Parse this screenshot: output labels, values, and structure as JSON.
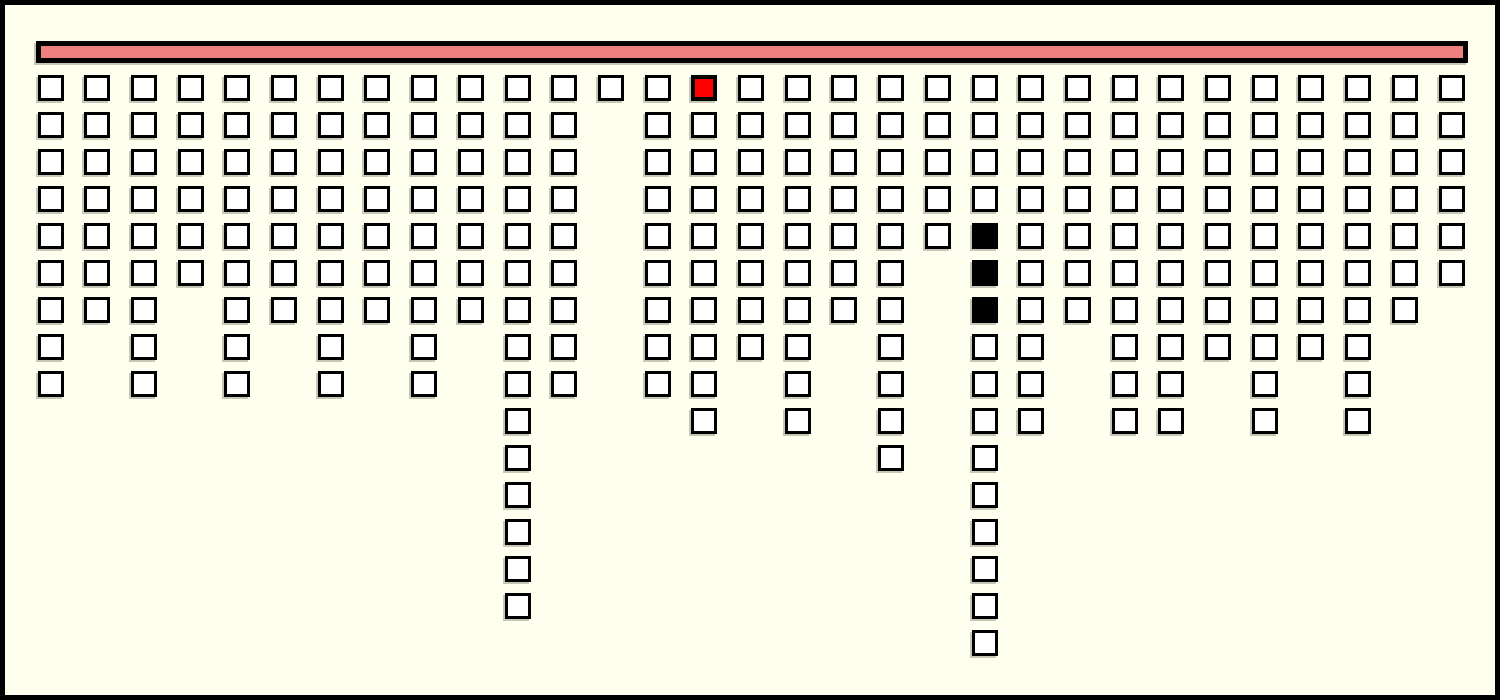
{
  "frame": {
    "description": "Plain framed board, no visible text anywhere",
    "width_px": 1500,
    "height_px": 700
  },
  "top_bar": {
    "role": "horizontal header bar the unit columns hang from"
  },
  "chart_data": {
    "type": "unit-column",
    "title": "",
    "xlabel": "",
    "ylabel": "",
    "orientation": "columns of unit squares hang downward from a horizontal bar at the top",
    "num_columns": 31,
    "categories": [
      1,
      2,
      3,
      4,
      5,
      6,
      7,
      8,
      9,
      10,
      11,
      12,
      13,
      14,
      15,
      16,
      17,
      18,
      19,
      20,
      21,
      22,
      23,
      24,
      25,
      26,
      27,
      28,
      29,
      30,
      31
    ],
    "counts": [
      9,
      7,
      9,
      6,
      9,
      7,
      9,
      7,
      9,
      7,
      15,
      9,
      1,
      9,
      10,
      8,
      10,
      7,
      11,
      5,
      16,
      10,
      7,
      10,
      10,
      8,
      10,
      8,
      10,
      7,
      6
    ],
    "max_count": 16,
    "total_units": 266,
    "highlight_cells": [
      {
        "col": 15,
        "row": 1,
        "color": "#FF0000",
        "label": "red-unit"
      },
      {
        "col": 21,
        "row": 5,
        "color": "#000000",
        "label": "black-unit"
      },
      {
        "col": 21,
        "row": 6,
        "color": "#000000",
        "label": "black-unit"
      },
      {
        "col": 21,
        "row": 7,
        "color": "#000000",
        "label": "black-unit"
      }
    ],
    "colors": {
      "background": "#FFFFF0",
      "frame_border": "#000000",
      "bar_fill": "#F08080",
      "bar_border": "#000000",
      "unit_fill": "#FFFFFF",
      "unit_border": "#000000",
      "highlight_red": "#FF0000",
      "highlight_black": "#000000",
      "shadow": "rgba(95,95,80,0.35)"
    },
    "grid": false,
    "legend": false
  }
}
